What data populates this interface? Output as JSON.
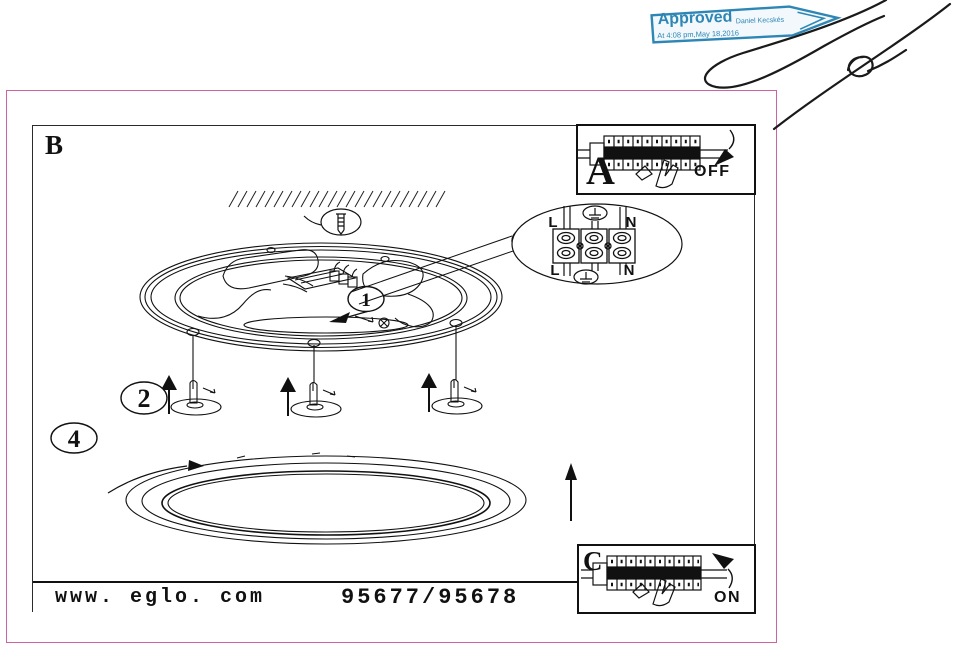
{
  "document": {
    "page_label": "B"
  },
  "stamp": {
    "title": "Approved",
    "approver": "Daniel Kecskés",
    "timestamp": "At 4:08 pm,May 18,2016",
    "accent_color": "#2e86b5"
  },
  "frame": {
    "border_color": "#cf62a2",
    "line_color": "#111111"
  },
  "details": {
    "a_label": "A",
    "a_state": "OFF",
    "c_label": "C",
    "c_state": "ON"
  },
  "callouts": {
    "one": "1",
    "two": "2",
    "three": "3",
    "four": "4"
  },
  "terminal": {
    "l_top": "L",
    "n_top": "N",
    "l_bottom": "L",
    "n_bottom": "N"
  },
  "footer": {
    "website": "www. eglo. com",
    "model": "95677/95678"
  }
}
